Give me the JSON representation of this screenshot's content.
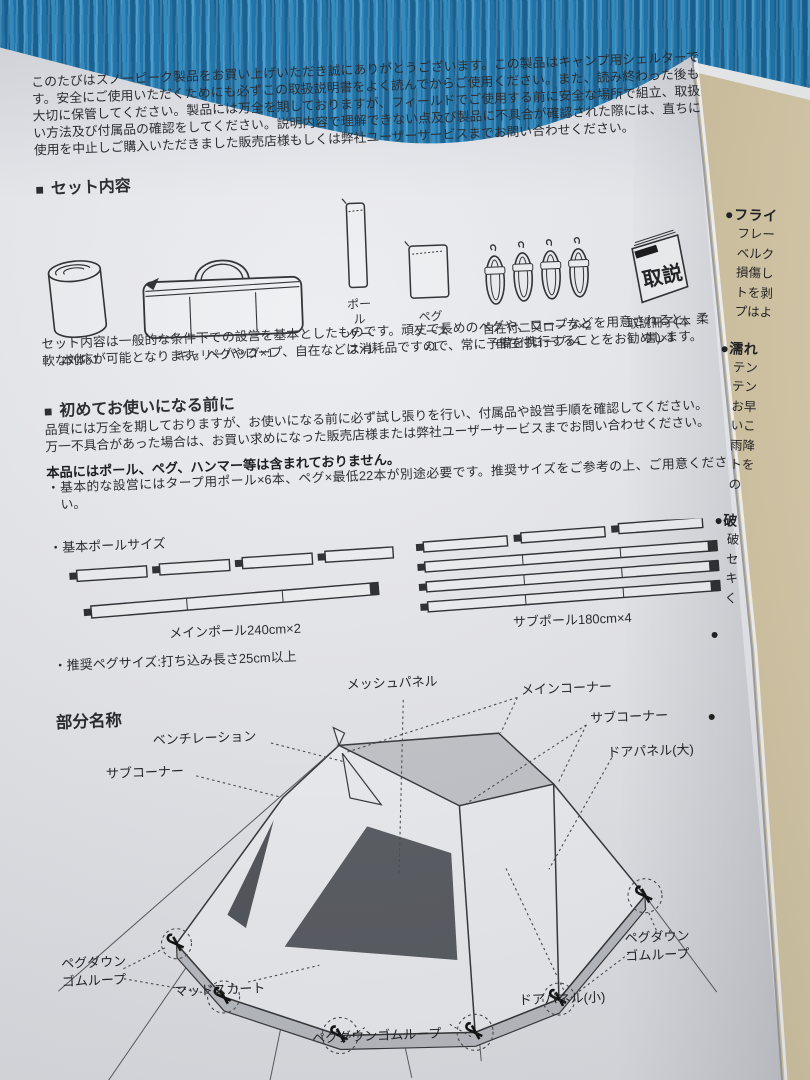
{
  "main_page": {
    "intro": "このたびはスノーピーク製品をお買い上げいただき誠にありがとうございます。この製品はキャンプ用シェルターです。安全にご使用いただくためにも必ずこの取扱説明書をよく読んでからご使用ください。また、読み終わった後も大切に保管してください。製品には万全を期しておりますが、フィールドでご使用する前に安全な場所で組立、取扱い方法及び付属品の確認をしてください。説明内容で理解できない点及び製品に不具合が確認された際には、直ちに使用を中止しご購入いただきました販売店様もしくは弊社ユーザーサービスまでお問い合わせください。",
    "set_contents": {
      "marker": "■",
      "heading": "セット内容",
      "items": [
        {
          "l1": "本体×1",
          "l2": ""
        },
        {
          "l1": "キャリーバッグ×1",
          "l2": ""
        },
        {
          "l1": "ポール",
          "l2": "ケース×1"
        },
        {
          "l1": "ペグ",
          "l2": "ケース×1"
        },
        {
          "l1": "自在付二又ロープ×2",
          "l2": "自在付ロープ×4"
        },
        {
          "l1": "取説冊子(本書)×1",
          "l2": ""
        }
      ],
      "booklet_cover_text": "取説",
      "note": "セット内容は一般的な条件下での設営を基本としたものです。頑丈で長めのペグや、ロープなどを用意されると、柔軟な対応が可能となります。ペグやロープ、自在などは消耗品ですので、常に予備を携行することをお勧めします。"
    },
    "first_use": {
      "marker": "■",
      "heading": "初めてお使いになる前に",
      "line1": "品質には万全を期しておりますが、お使いになる前に必ず試し張りを行い、付属品や設営手順を確認してください。",
      "line2": "万一不具合があった場合は、お買い求めになった販売店様または弊社ユーザーサービスまでお問い合わせください。",
      "bold_note": "本品にはポール、ペグ、ハンマー等は含まれておりません。",
      "requirement": "・基本的な設営にはタープ用ポール×6本、ペグ×最低22本が別途必要です。推奨サイズをご参考の上、ご用意ください。"
    },
    "pole_size": {
      "label": "・基本ポールサイズ",
      "main_pole": "メインポール240cm×2",
      "sub_pole": "サブポール180cm×4"
    },
    "peg_size": "・推奨ペグサイズ:打ち込み長さ25cm以上",
    "parts": {
      "heading": "部分名称",
      "labels": {
        "mesh_panel": "メッシュパネル",
        "main_corner": "メインコーナー",
        "sub_corner_right": "サブコーナー",
        "door_panel_large": "ドアパネル(大)",
        "ventilation": "ベンチレーション",
        "sub_corner_left": "サブコーナー",
        "peg_loop_left_1": "ペグダウン",
        "peg_loop_left_2": "ゴムループ",
        "mud_skirt": "マッドスカート",
        "peg_loop_bottom": "ペグダウンゴムループ",
        "door_panel_small": "ドアパネル(小)",
        "peg_loop_right_1": "ペグダウン",
        "peg_loop_right_2": "ゴムループ"
      }
    }
  },
  "next_page": {
    "sections": [
      {
        "title": "●フライ",
        "lines": [
          "フレー",
          "ベルク",
          "損傷し",
          "トを剥",
          "プはよ"
        ]
      },
      {
        "title": "●濡れ",
        "lines": [
          "テン",
          "テン",
          "お早",
          "いこ",
          "雨降",
          "トを",
          "の"
        ]
      },
      {
        "title": "●破",
        "lines": [
          "破",
          "セ",
          "キ",
          "く"
        ]
      },
      {
        "title": "●",
        "lines": []
      },
      {
        "title": "●",
        "lines": []
      }
    ]
  },
  "colors": {
    "tarp_blue": "#1d79b4",
    "page_white": "#e9eaef",
    "next_page_cream": "#d6c9a8",
    "ink": "#26272b",
    "roof_gray": "#c5c7cc",
    "mesh_dark": "#5a5d63"
  }
}
